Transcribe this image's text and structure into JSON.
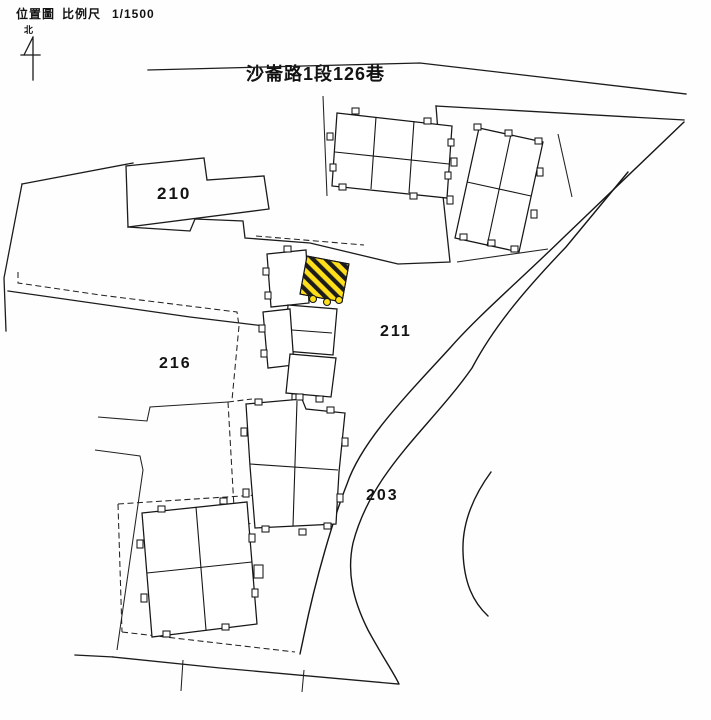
{
  "header": {
    "title": "位置圖",
    "scale_label": "比例尺",
    "scale_value": "1/1500"
  },
  "north_arrow": {
    "label": "北"
  },
  "street": {
    "name": "沙崙路1段126巷"
  },
  "lots": {
    "lot210": "210",
    "lot211": "211",
    "lot216": "216",
    "lot203": "203"
  },
  "subject_building": {
    "note": "hatched highlighted building",
    "fill": "#ffdf1a",
    "hatch_color": "#1c1c1c"
  },
  "colors": {
    "background": "#fefefe",
    "line": "#1c1c1c"
  }
}
